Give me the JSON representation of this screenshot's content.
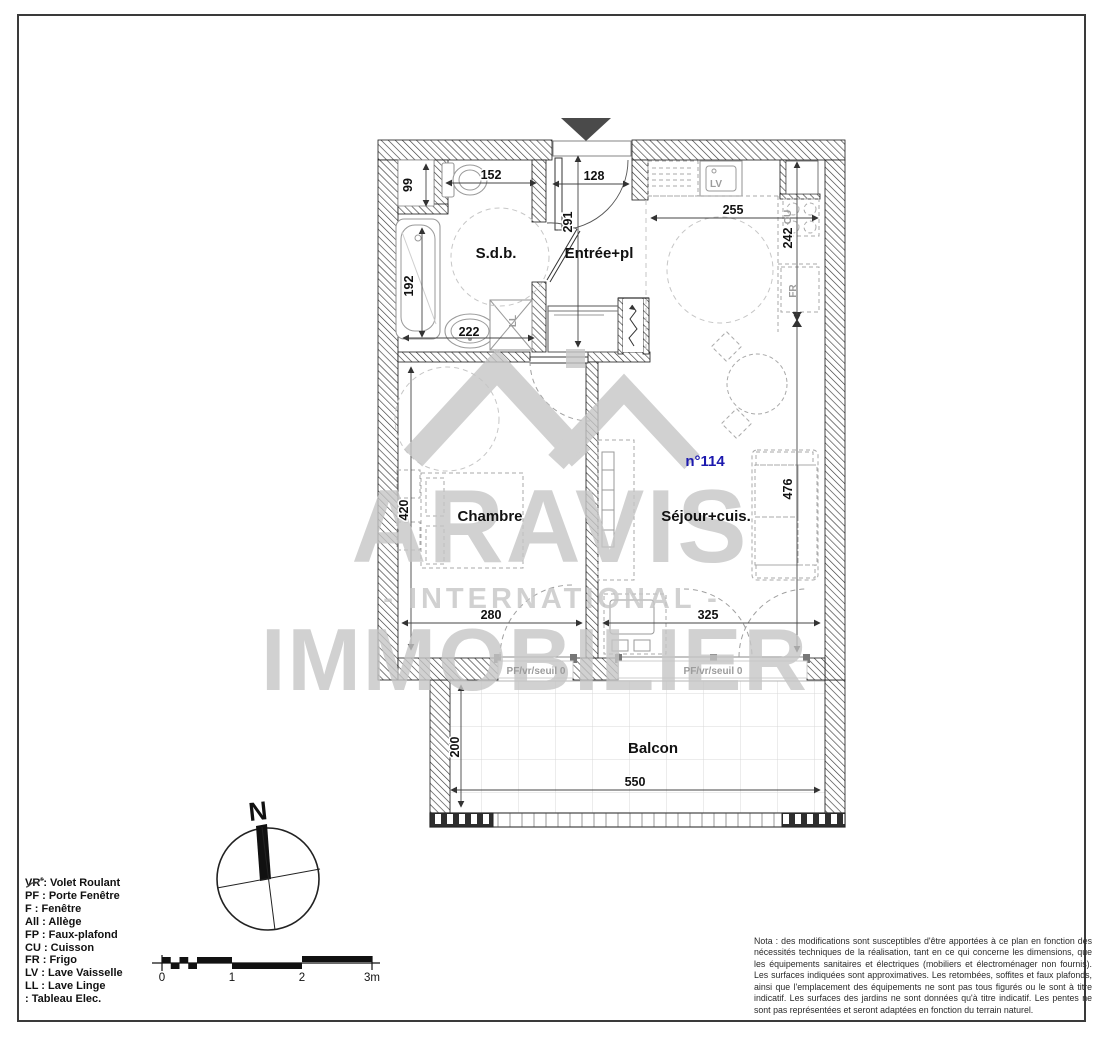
{
  "plan": {
    "unit_label": "n°114",
    "rooms": {
      "bathroom": "S.d.b.",
      "entrance": "Entrée+pl",
      "bedroom": "Chambre",
      "living": "Séjour+cuis.",
      "balcony": "Balcon"
    },
    "dimensions": {
      "niche": "99",
      "wc": "152",
      "entrance_width": "128",
      "entrance_depth": "291",
      "kitchen_width": "255",
      "kitchen_depth": "242",
      "bath_length": "192",
      "bath_width": "222",
      "bedroom_depth": "420",
      "living_depth": "476",
      "bedroom_width": "280",
      "living_width": "325",
      "balcony_depth": "200",
      "balcony_width": "550"
    },
    "appliances": {
      "dishwasher": "LV",
      "hob": "CU",
      "fridge": "FR",
      "washer": "LL"
    },
    "window_label": "PF/vr/seuil 0"
  },
  "watermark": {
    "name": "ARAVIS",
    "subtitle": "- INTERNATIONAL -",
    "tagline": "IMMOBILIER"
  },
  "compass": {
    "north": "N"
  },
  "scale_bar": {
    "t0": "0",
    "t1": "1",
    "t2": "2",
    "t3": "3m"
  },
  "legend": {
    "items": [
      "VR : Volet Roulant",
      "PF : Porte Fenêtre",
      "F : Fenêtre",
      "All : Allège",
      "FP : Faux-plafond",
      "CU : Cuisson",
      "FR : Frigo",
      "LV : Lave Vaisselle",
      "LL : Lave Linge"
    ],
    "tableau": ": Tableau Elec."
  },
  "nota": "Nota : des modifications sont susceptibles d'être apportées à ce plan en fonction des nécessités techniques de la réalisation, tant en ce qui concerne les dimensions, que les équipements sanitaires et électriques (mobiliers et électroménager non fournis). Les surfaces indiquées sont approximatives. Les retombées, soffites et faux plafonds, ainsi que l'emplacement des équipements ne sont pas tous figurés ou le sont à titre indicatif. Les surfaces des jardins ne sont données qu'à titre indicatif. Les pentes ne sont pas représentées et seront adaptées en fonction du terrain naturel.",
  "colors": {
    "unit_accent": "#1c19ae",
    "watermark": "#c6c6c6"
  }
}
